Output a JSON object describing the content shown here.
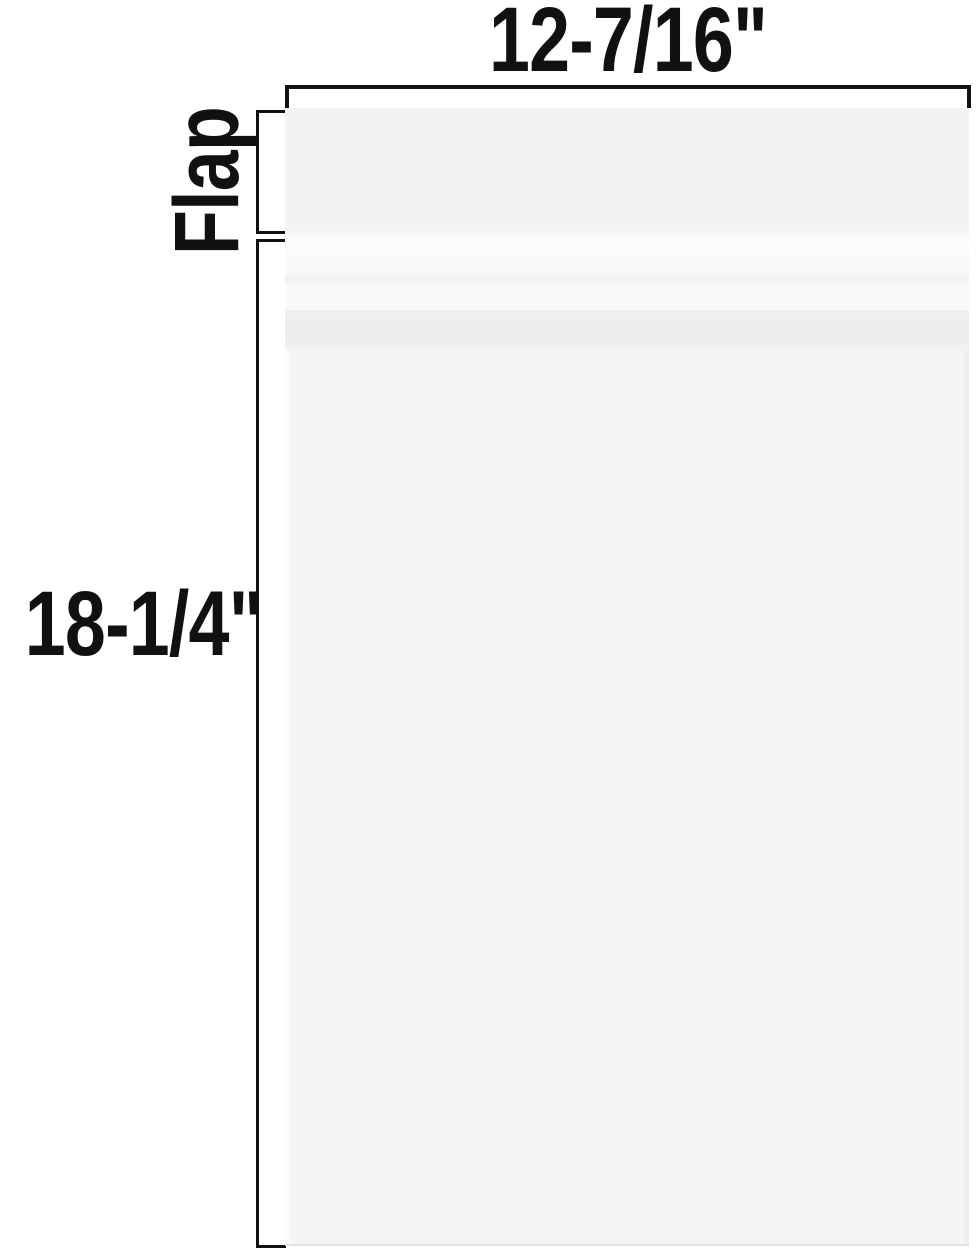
{
  "diagram": {
    "type": "product-dimension-diagram",
    "subject": "clear resealable cellophane bag with adhesive flap",
    "width_label": "12-7/16\"",
    "height_label": "18-1/4\"",
    "flap_label": "Flap"
  },
  "dimensions": {
    "bag_width_inches": "12-7/16",
    "bag_height_inches": "18-1/4"
  },
  "colors": {
    "ink": "#111111",
    "background": "#ffffff",
    "bag_flap": "#f2f2f3",
    "bag_body": "#f4f4f5",
    "bag_highlight": "#fafafa",
    "bag_fold_line": "#f0f0f1",
    "bag_strip": "#ededee",
    "bag_bottom_seam": "#e3e3e4"
  }
}
